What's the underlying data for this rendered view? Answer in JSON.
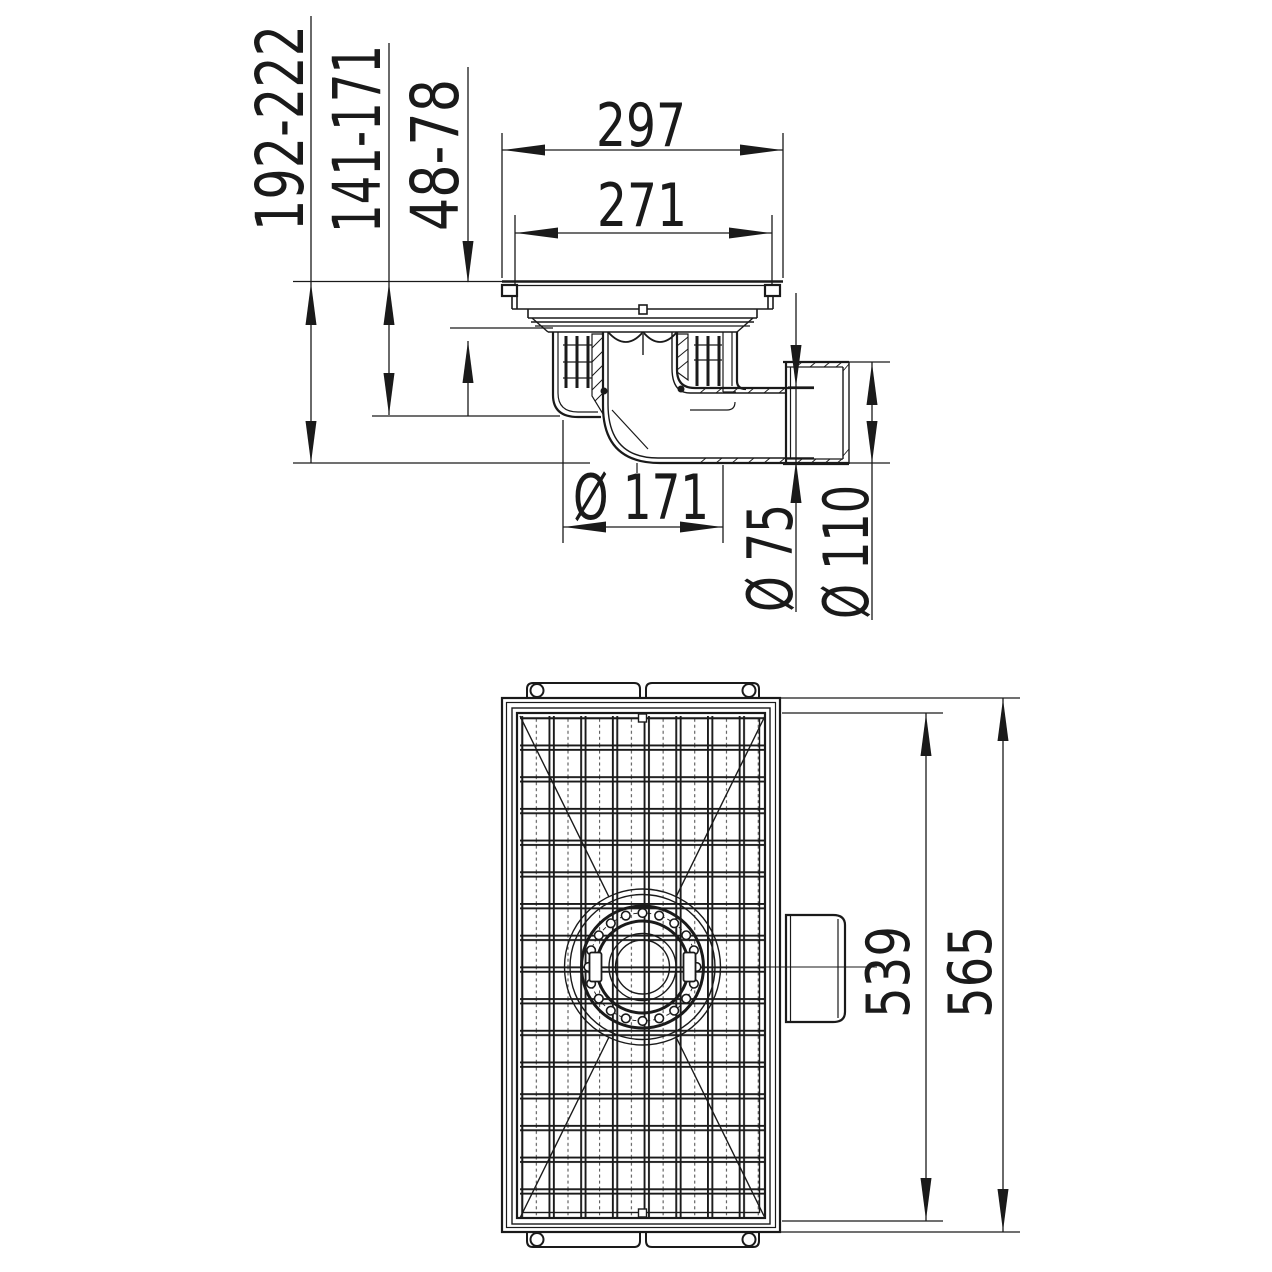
{
  "drawing": {
    "background": "#ffffff",
    "line_color": "#1a1a1a",
    "dimensions": {
      "height_total": "192-222",
      "height_to_outlet": "141-171",
      "height_upper": "48-78",
      "top_width_outer": "297",
      "top_width_inner": "271",
      "body_diameter": "Ø 171",
      "outlet_pipe_diameter": "Ø 75",
      "socket_diameter": "Ø 110",
      "plan_length_inner": "539",
      "plan_length_outer": "565"
    }
  }
}
